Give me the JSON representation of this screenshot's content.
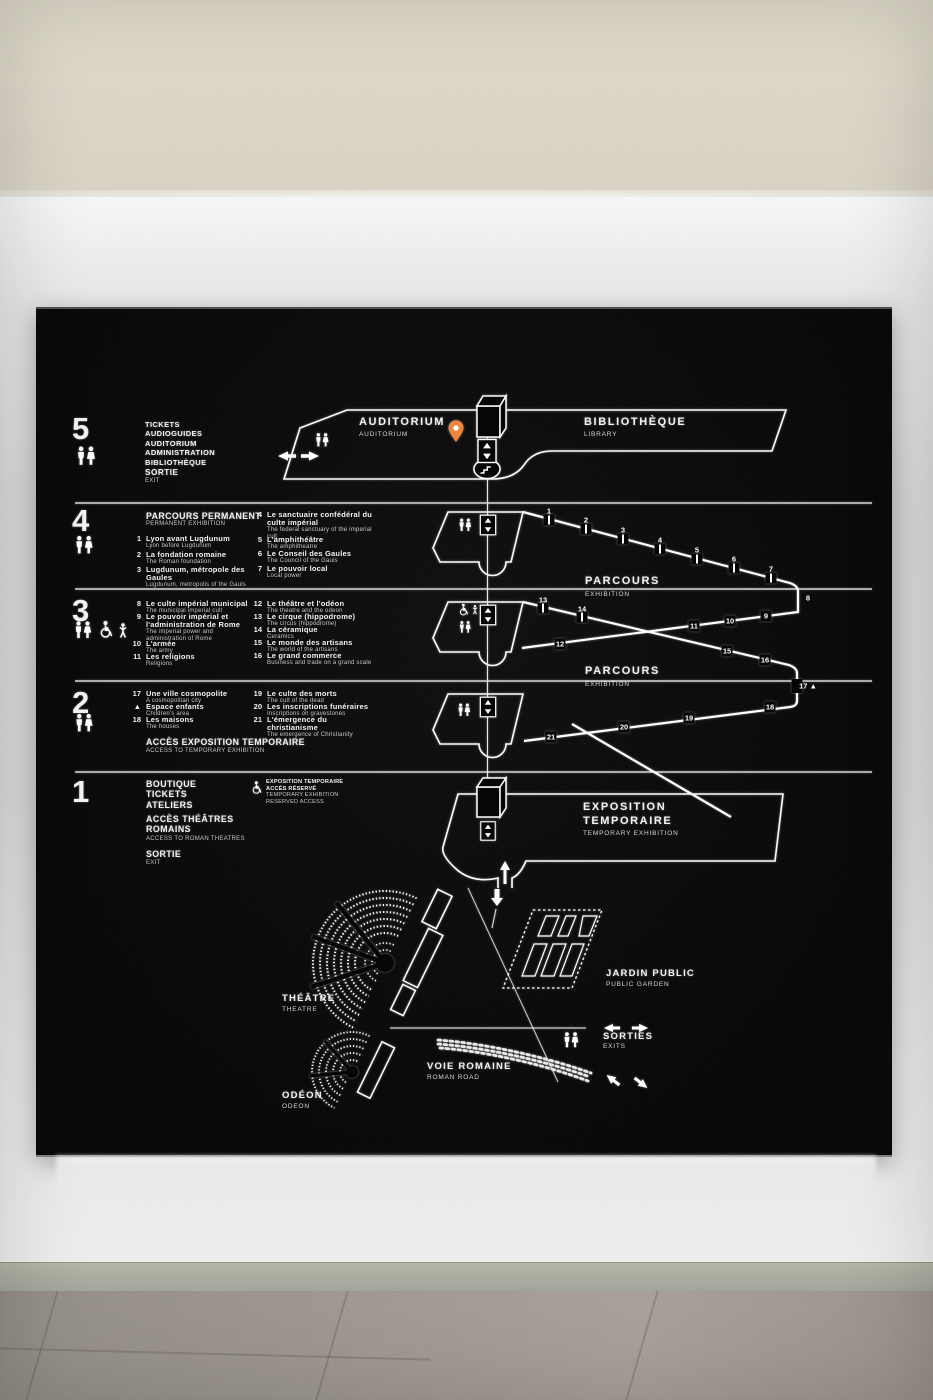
{
  "sign": {
    "f5": {
      "num": "5",
      "services": [
        "TICKETS",
        "AUDIOGUIDES",
        "AUDITORIUM",
        "ADMINISTRATION",
        "BIBLIOTHÈQUE"
      ],
      "sortie_fr": "SORTIE",
      "sortie_en": "EXIT",
      "auditorium_fr": "AUDITORIUM",
      "auditorium_en": "AUDITORIUM",
      "bibliotheque_fr": "BIBLIOTHÈQUE",
      "bibliotheque_en": "LIBRARY"
    },
    "f4": {
      "num": "4",
      "heading_fr": "PARCOURS PERMANENT",
      "heading_en": "PERMANENT EXHIBITION",
      "items": [
        {
          "n": "1",
          "fr": "Lyon avant Lugdunum",
          "en": "Lyon before Lugdunum"
        },
        {
          "n": "2",
          "fr": "La fondation romaine",
          "en": "The Roman foundation"
        },
        {
          "n": "3",
          "fr": "Lugdunum, métropole des Gaules",
          "en": "Lugdunum, metropolis of the Gauls"
        },
        {
          "n": "4",
          "fr": "Le sanctuaire confédéral du culte impérial",
          "en": "The federal sanctuary of the imperial cult"
        },
        {
          "n": "5",
          "fr": "L'amphithéâtre",
          "en": "The amphitheatre"
        },
        {
          "n": "6",
          "fr": "Le Conseil des Gaules",
          "en": "The Council of the Gauls"
        },
        {
          "n": "7",
          "fr": "Le pouvoir local",
          "en": "Local power"
        }
      ],
      "parcours_fr": "PARCOURS",
      "parcours_en": "EXHIBITION"
    },
    "f3": {
      "num": "3",
      "items": [
        {
          "n": "8",
          "fr": "Le culte impérial municipal",
          "en": "The municipal imperial cult"
        },
        {
          "n": "9",
          "fr": "Le pouvoir impérial et l'administration de Rome",
          "en": "The imperial power and administration of Rome"
        },
        {
          "n": "10",
          "fr": "L'armée",
          "en": "The army"
        },
        {
          "n": "11",
          "fr": "Les religions",
          "en": "Religions"
        },
        {
          "n": "12",
          "fr": "Le théâtre et l'odéon",
          "en": "The theatre and the odeon"
        },
        {
          "n": "13",
          "fr": "Le cirque (hippodrome)",
          "en": "The circus (hippodrome)"
        },
        {
          "n": "14",
          "fr": "La céramique",
          "en": "Ceramics"
        },
        {
          "n": "15",
          "fr": "Le monde des artisans",
          "en": "The world of the artisans"
        },
        {
          "n": "16",
          "fr": "Le grand commerce",
          "en": "Business and trade on a grand scale"
        }
      ],
      "parcours_fr": "PARCOURS",
      "parcours_en": "EXHIBITION"
    },
    "f2": {
      "num": "2",
      "items": [
        {
          "n": "17",
          "fr": "Une ville cosmopolite",
          "en": "A cosmopolitan city"
        },
        {
          "n": "▲",
          "fr": "Espace enfants",
          "en": "Children's area"
        },
        {
          "n": "18",
          "fr": "Les maisons",
          "en": "The houses"
        },
        {
          "n": "19",
          "fr": "Le culte des morts",
          "en": "The cult of the dead"
        },
        {
          "n": "20",
          "fr": "Les inscriptions funéraires",
          "en": "Inscriptions on gravestones"
        },
        {
          "n": "21",
          "fr": "L'émergence du christianisme",
          "en": "The emergence of Christianity"
        }
      ],
      "acces_fr": "ACCÈS EXPOSITION TEMPORAIRE",
      "acces_en": "ACCESS TO TEMPORARY EXHIBITION"
    },
    "f1": {
      "num": "1",
      "services": [
        "BOUTIQUE",
        "TICKETS",
        "ATELIERS"
      ],
      "acces_fr": "ACCÈS THÉÂTRES ROMAINS",
      "acces_en": "ACCESS TO ROMAN THEATRES",
      "sortie_fr": "SORTIE",
      "sortie_en": "EXIT",
      "reserved": [
        "EXPOSITION TEMPORAIRE",
        "ACCÈS RÉSERVÉ",
        "TEMPORARY EXHIBITION",
        "RESERVED ACCESS"
      ],
      "expo_fr1": "EXPOSITION",
      "expo_fr2": "TEMPORAIRE",
      "expo_en": "TEMPORARY EXHIBITION"
    },
    "outdoor": {
      "theatre_fr": "THÉÂTRE",
      "theatre_en": "THEATRE",
      "odeon_fr": "ODÉON",
      "odeon_en": "ODEON",
      "jardin_fr": "JARDIN PUBLIC",
      "jardin_en": "PUBLIC GARDEN",
      "voie_fr": "VOIE ROMAINE",
      "voie_en": "ROMAN ROAD",
      "sorties_fr": "SORTIES",
      "sorties_en": "EXITS"
    },
    "stations": {
      "s1": "1",
      "s2": "2",
      "s3": "3",
      "s4": "4",
      "s5": "5",
      "s6": "6",
      "s7": "7",
      "s8": "8",
      "s9": "9",
      "s10": "10",
      "s11": "11",
      "s12": "12",
      "s13": "13",
      "s14": "14",
      "s15": "15",
      "s16": "16",
      "s17": "17 ▲",
      "s18": "18",
      "s19": "19",
      "s20": "20",
      "s21": "21"
    }
  },
  "colors": {
    "pin": "#ec8540",
    "panel": "#060606",
    "line": "#ffffff"
  }
}
